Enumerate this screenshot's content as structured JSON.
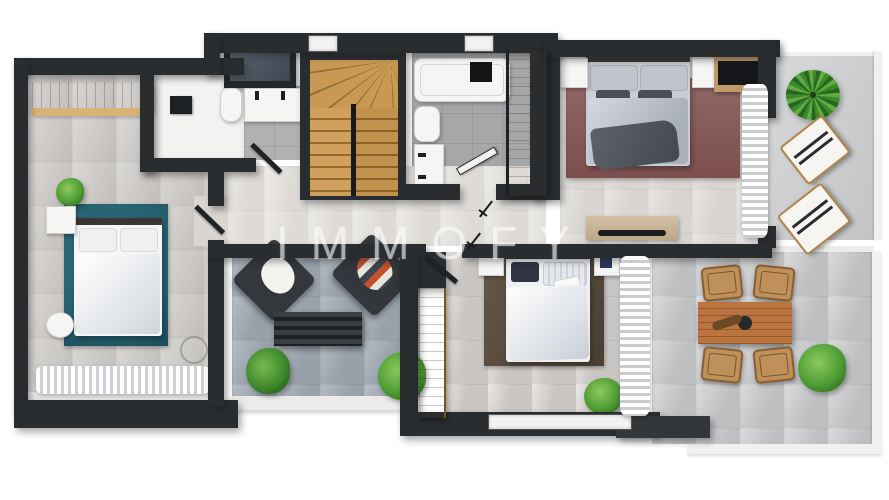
{
  "watermark": {
    "text": "IMMOFY"
  },
  "scene": {
    "type": "3d-floor-plan-top-view",
    "rooms": [
      {
        "id": "bedroom-left",
        "furniture": [
          "wardrobe",
          "double-bed",
          "teal-rug",
          "nightstand",
          "plant",
          "ceiling-fan",
          "balcony-curtain"
        ]
      },
      {
        "id": "shower-room",
        "furniture": [
          "walk-in-shower",
          "toilet",
          "double-sink-vanity",
          "dark-cabinet"
        ]
      },
      {
        "id": "staircase",
        "furniture": [
          "winder-stairs"
        ]
      },
      {
        "id": "bathroom",
        "furniture": [
          "bathtub",
          "toilet",
          "sink-vanity",
          "door"
        ]
      },
      {
        "id": "entry-hall",
        "furniture": [
          "entry-door",
          "tall-wardrobe",
          "door-swings"
        ]
      },
      {
        "id": "master-bedroom",
        "furniture": [
          "double-bed",
          "maroon-rug",
          "nightstand",
          "nightstand",
          "tv-desk",
          "sideboard",
          "curtain"
        ]
      },
      {
        "id": "balcony-top-right",
        "furniture": [
          "palm-plant",
          "sun-lounger",
          "sun-lounger"
        ]
      },
      {
        "id": "terrace-middle",
        "furniture": [
          "lounge-chair",
          "lounge-chair",
          "slatted-bench",
          "plant",
          "plant"
        ]
      },
      {
        "id": "bedroom-bottom",
        "furniture": [
          "double-bed",
          "brown-rug",
          "tall-wardrobe",
          "nightstand",
          "nightstand",
          "plant",
          "curtain",
          "window"
        ]
      },
      {
        "id": "terrace-right",
        "furniture": [
          "dining-table",
          "chair",
          "chair",
          "chair",
          "chair",
          "plant"
        ]
      }
    ]
  },
  "palette": {
    "wall": "#2a2d30",
    "floor_light": "#dbd8d4",
    "floor_gray": "#c7c4c1",
    "bath_tile": "#a6a7a9",
    "terrace_blue": "#98a1aa",
    "terrace_gray": "#bebfc1",
    "wood": "#b5854a",
    "wood_light": "#cba05f",
    "table_wood": "#b06a38",
    "chair_tan": "#c0905a",
    "rug_teal": "#276271",
    "rug_maroon": "#875c5a",
    "rug_brown": "#55483c",
    "plant_green": "#4f9e35",
    "bedding_blue": "#b7bdc6",
    "accent_orange": "#c2512f",
    "curtain_white": "#ffffff",
    "watermark_color": "rgba(255,255,255,0.55)"
  }
}
